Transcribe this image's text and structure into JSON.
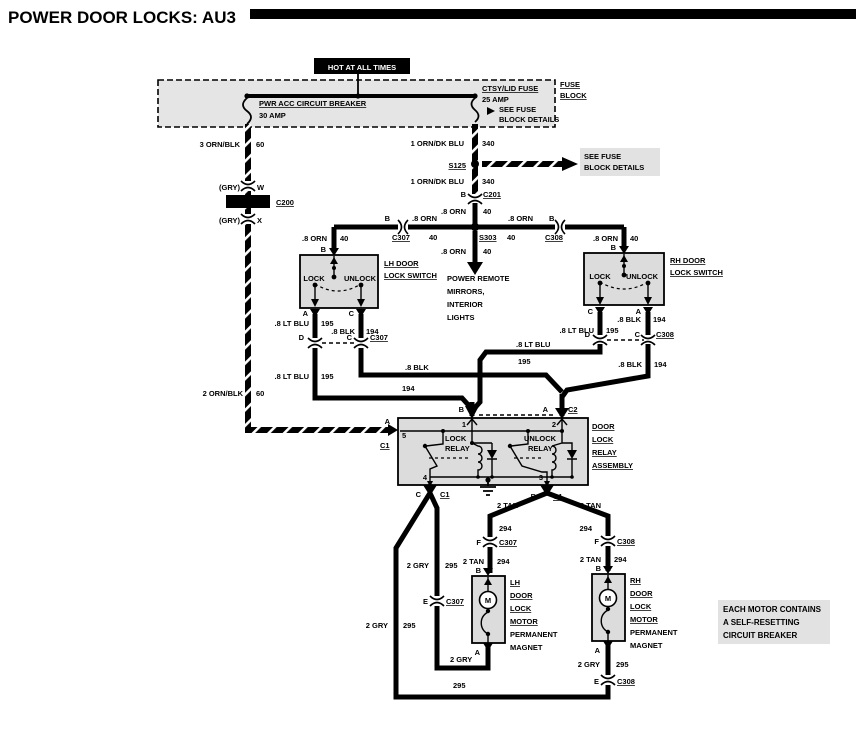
{
  "title": "POWER DOOR LOCKS: AU3",
  "fuse_block": {
    "hot": "HOT AT ALL TIMES",
    "name_l1": "FUSE",
    "name_l2": "BLOCK",
    "breaker": "PWR ACC CIRCUIT BREAKER",
    "breaker_amp": "30 AMP",
    "fuse": "CTSY/LID FUSE",
    "fuse_amp": "25 AMP",
    "note_l1": "SEE FUSE",
    "note_l2": "BLOCK DETAILS"
  },
  "notes": {
    "see_fuse_l1": "SEE FUSE",
    "see_fuse_l2": "BLOCK DETAILS",
    "motor_l1": "EACH MOTOR CONTAINS",
    "motor_l2": "A SELF-RESETTING",
    "motor_l3": "CIRCUIT BREAKER",
    "power_remote_l1": "POWER REMOTE",
    "power_remote_l2": "MIRRORS,",
    "power_remote_l3": "INTERIOR",
    "power_remote_l4": "LIGHTS"
  },
  "wires": {
    "orn_blk_3": "3 ORN/BLK",
    "orn_blk_2": "2 ORN/BLK",
    "orn_dk_blu_1": "1 ORN/DK BLU",
    "orn": ".8 ORN",
    "lt_blu": ".8 LT BLU",
    "blk": ".8 BLK",
    "tan": "2 TAN",
    "gry": "2 GRY",
    "gry_case": "(GRY)"
  },
  "circuits": {
    "n40": "40",
    "n60": "60",
    "n194": "194",
    "n195": "195",
    "n294": "294",
    "n295": "295",
    "n340": "340"
  },
  "connectors": {
    "c200": "C200",
    "c201": "C201",
    "c307": "C307",
    "c308": "C308",
    "c1": "C1",
    "c2": "C2",
    "s125": "S125",
    "s303": "S303"
  },
  "terminals": {
    "a": "A",
    "b": "B",
    "c": "C",
    "d": "D",
    "e": "E",
    "f": "F",
    "w": "W",
    "x": "X"
  },
  "pins": {
    "p1": "1",
    "p2": "2",
    "p3": "3",
    "p4": "4",
    "p5": "5"
  },
  "switches": {
    "lock": "LOCK",
    "unlock": "UNLOCK",
    "lh_l1": "LH DOOR",
    "rh_l1": "RH DOOR",
    "l2": "LOCK SWITCH"
  },
  "relay": {
    "l1": "DOOR",
    "l2": "LOCK",
    "l3": "RELAY",
    "l4": "ASSEMBLY",
    "lock": "LOCK",
    "unlock": "UNLOCK",
    "relay_word": "RELAY"
  },
  "motors": {
    "lh_l1": "LH",
    "rh_l1": "RH",
    "l2": "DOOR",
    "l3": "LOCK",
    "l4": "MOTOR",
    "l5": "PERMANENT",
    "l6": "MAGNET",
    "m": "M"
  }
}
